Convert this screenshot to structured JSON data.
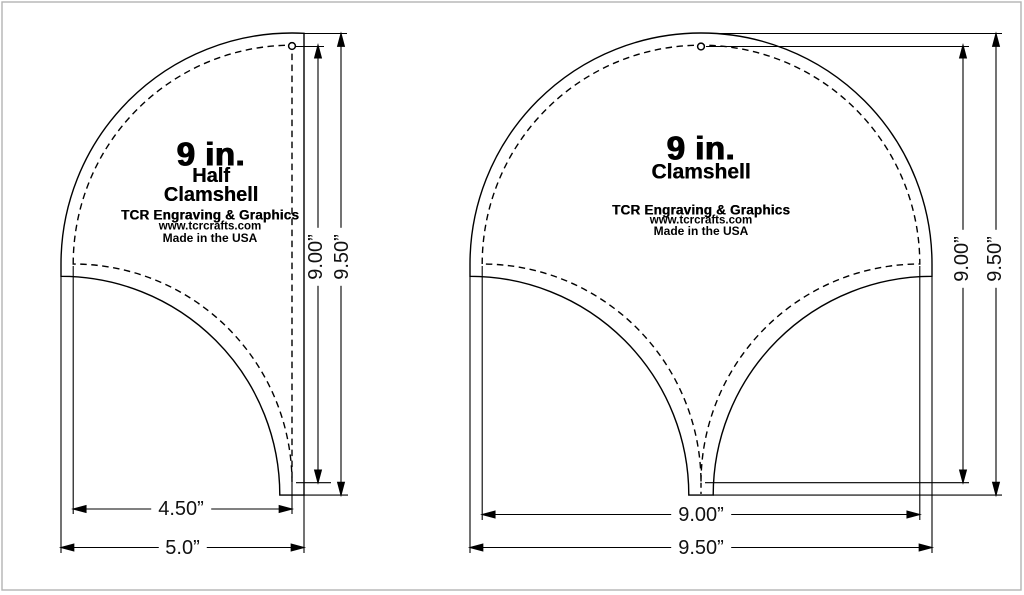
{
  "half": {
    "size": "9 in.",
    "name1": "Half",
    "name2": "Clamshell",
    "brand": "TCR Engraving & Graphics",
    "website": "www.tcrcrafts.com",
    "made_in": "Made in the USA",
    "width_finished": "4.50”",
    "width_total": "5.0”",
    "height_finished": "9.00”",
    "height_total": "9.50”"
  },
  "full": {
    "size": "9 in.",
    "name1": "Clamshell",
    "brand": "TCR Engraving & Graphics",
    "website": "www.tcrcrafts.com",
    "made_in": "Made in the USA",
    "width_finished": "9.00”",
    "width_total": "9.50”",
    "height_finished": "9.00”",
    "height_total": "9.50”"
  },
  "colors": {
    "line": "#000000",
    "background": "#ffffff",
    "page_border": "#b3b3b3"
  }
}
